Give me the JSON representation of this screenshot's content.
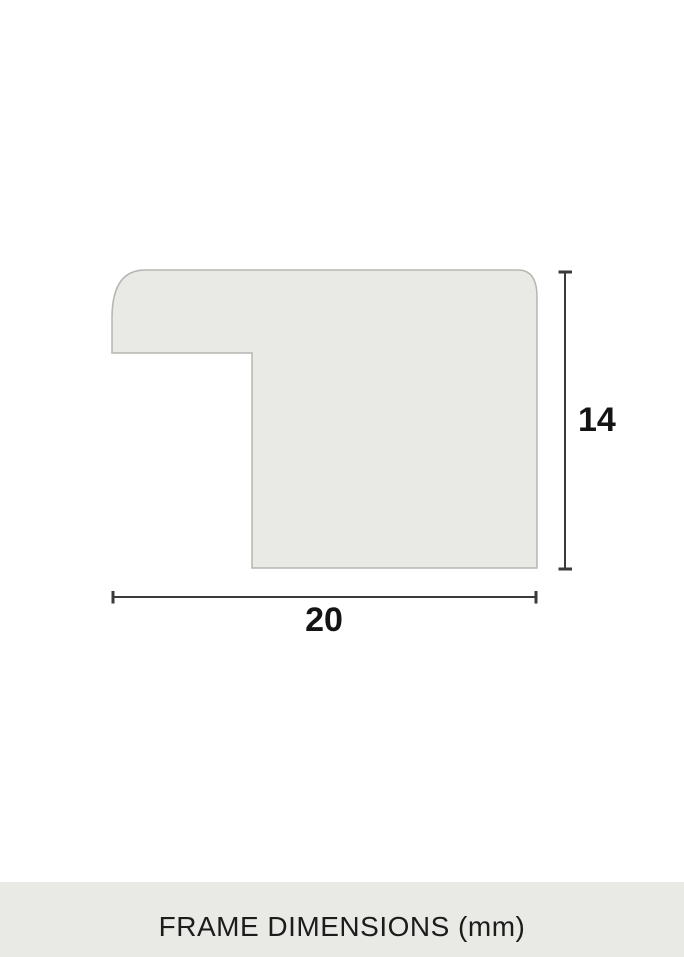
{
  "diagram": {
    "caption": "FRAME DIMENSIONS (mm)",
    "unit": "mm",
    "width_label": "20",
    "height_label": "14"
  },
  "colors": {
    "background": "#ffffff",
    "shape_fill": "#e9eae6",
    "shape_stroke": "#b5b5b2",
    "dimension_line": "#3a3a3a",
    "label_text": "#141414",
    "caption_band": "#e9eae6",
    "caption_text": "#1c1c1c"
  }
}
